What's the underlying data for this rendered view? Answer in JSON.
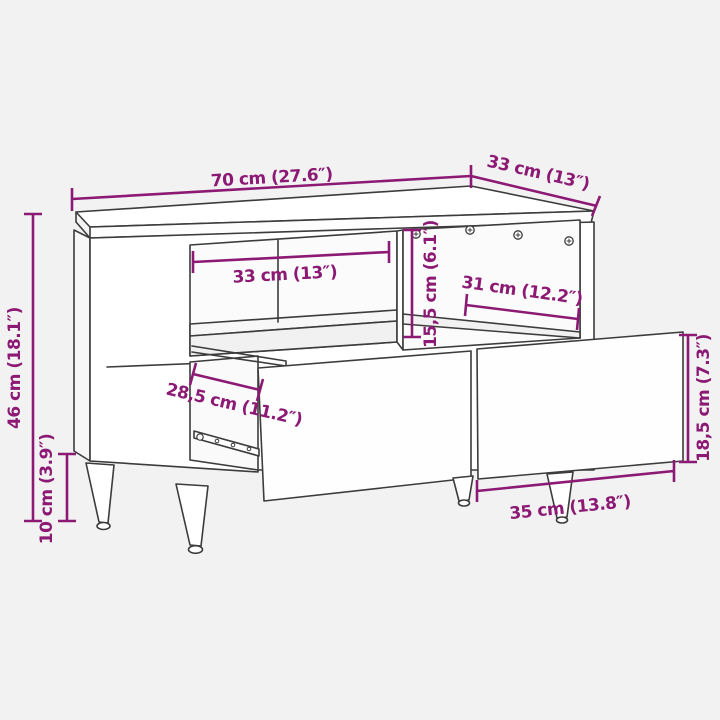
{
  "diagram_type": "furniture-dimension-diagram",
  "product": "tv-cabinet-with-two-drawers",
  "colors": {
    "background": "#f2f2f2",
    "outline": "#3c3c3c",
    "dimension": "#8c1a74",
    "face": "#ffffff"
  },
  "dimensions": {
    "overall_width": {
      "label": "70 cm (27.6″)"
    },
    "overall_depth": {
      "label": "33 cm (13″)"
    },
    "overall_height": {
      "label": "46 cm (18.1″)"
    },
    "leg_height": {
      "label": "10 cm (3.9″)"
    },
    "compartment_width": {
      "label": "33 cm (13″)"
    },
    "compartment_height": {
      "label": "15,5 cm (6.1″)"
    },
    "compartment_depth": {
      "label": "31 cm (12.2″)"
    },
    "drawer_depth": {
      "label": "28,5 cm (11.2″)"
    },
    "drawer_front_height": {
      "label": "18,5 cm (7.3″)"
    },
    "drawer_front_width": {
      "label": "35 cm (13.8″)"
    }
  }
}
